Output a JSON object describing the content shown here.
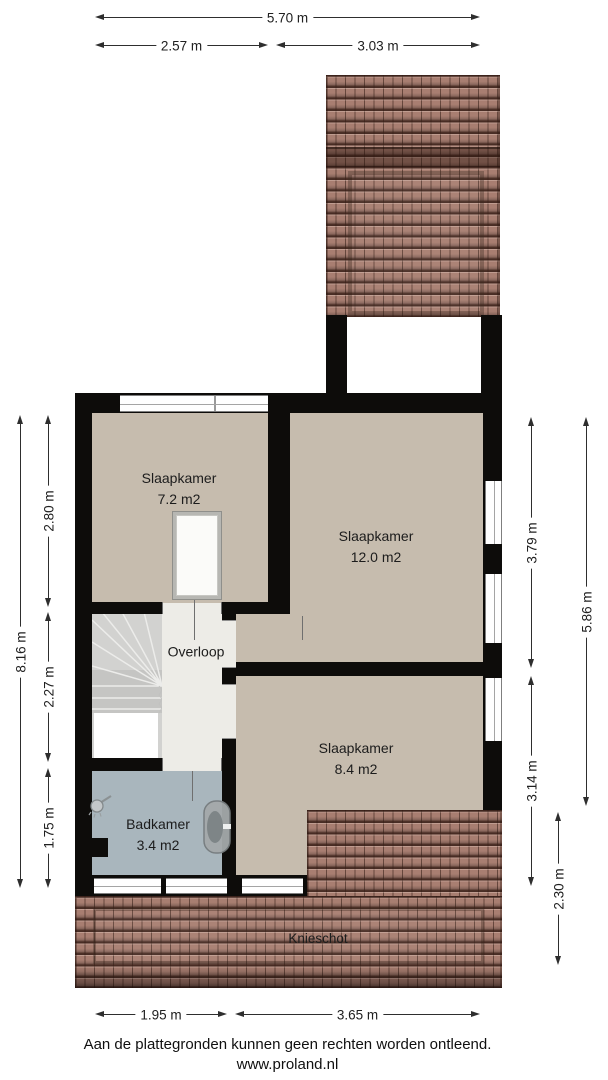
{
  "dims": {
    "top_total": "5.70 m",
    "top_left": "2.57 m",
    "top_right": "3.03 m",
    "left_total": "8.16 m",
    "left_top": "2.80 m",
    "left_mid": "2.27 m",
    "left_bottom": "1.75 m",
    "right_top": "3.79 m",
    "right_bottom": "3.14 m",
    "right_total": "5.86 m",
    "right_roof": "2.30 m",
    "bottom_left": "1.95 m",
    "bottom_right": "3.65 m"
  },
  "rooms": {
    "bedroom_small": {
      "label": "Slaapkamer",
      "area": "7.2 m2"
    },
    "bedroom_large": {
      "label": "Slaapkamer",
      "area": "12.0 m2"
    },
    "bedroom_mid": {
      "label": "Slaapkamer",
      "area": "8.4 m2"
    },
    "landing": {
      "label": "Overloop"
    },
    "bathroom": {
      "label": "Badkamer",
      "area": "3.4 m2"
    },
    "kneewall": {
      "label": "Knieschot"
    }
  },
  "footer": {
    "disclaimer": "Aan de plattegronden kunnen geen rechten worden ontleend.",
    "website": "www.proland.nl"
  },
  "colors": {
    "wall": "#0d0c0a",
    "floor": "#c6bcae",
    "landing": "#edece7",
    "bathroom": "#a9b6bd",
    "stairs": "#d2d2d0",
    "roof_tile": "#a87e71",
    "roof_dark": "#3e241a",
    "dim_line": "#2e2e2e"
  }
}
